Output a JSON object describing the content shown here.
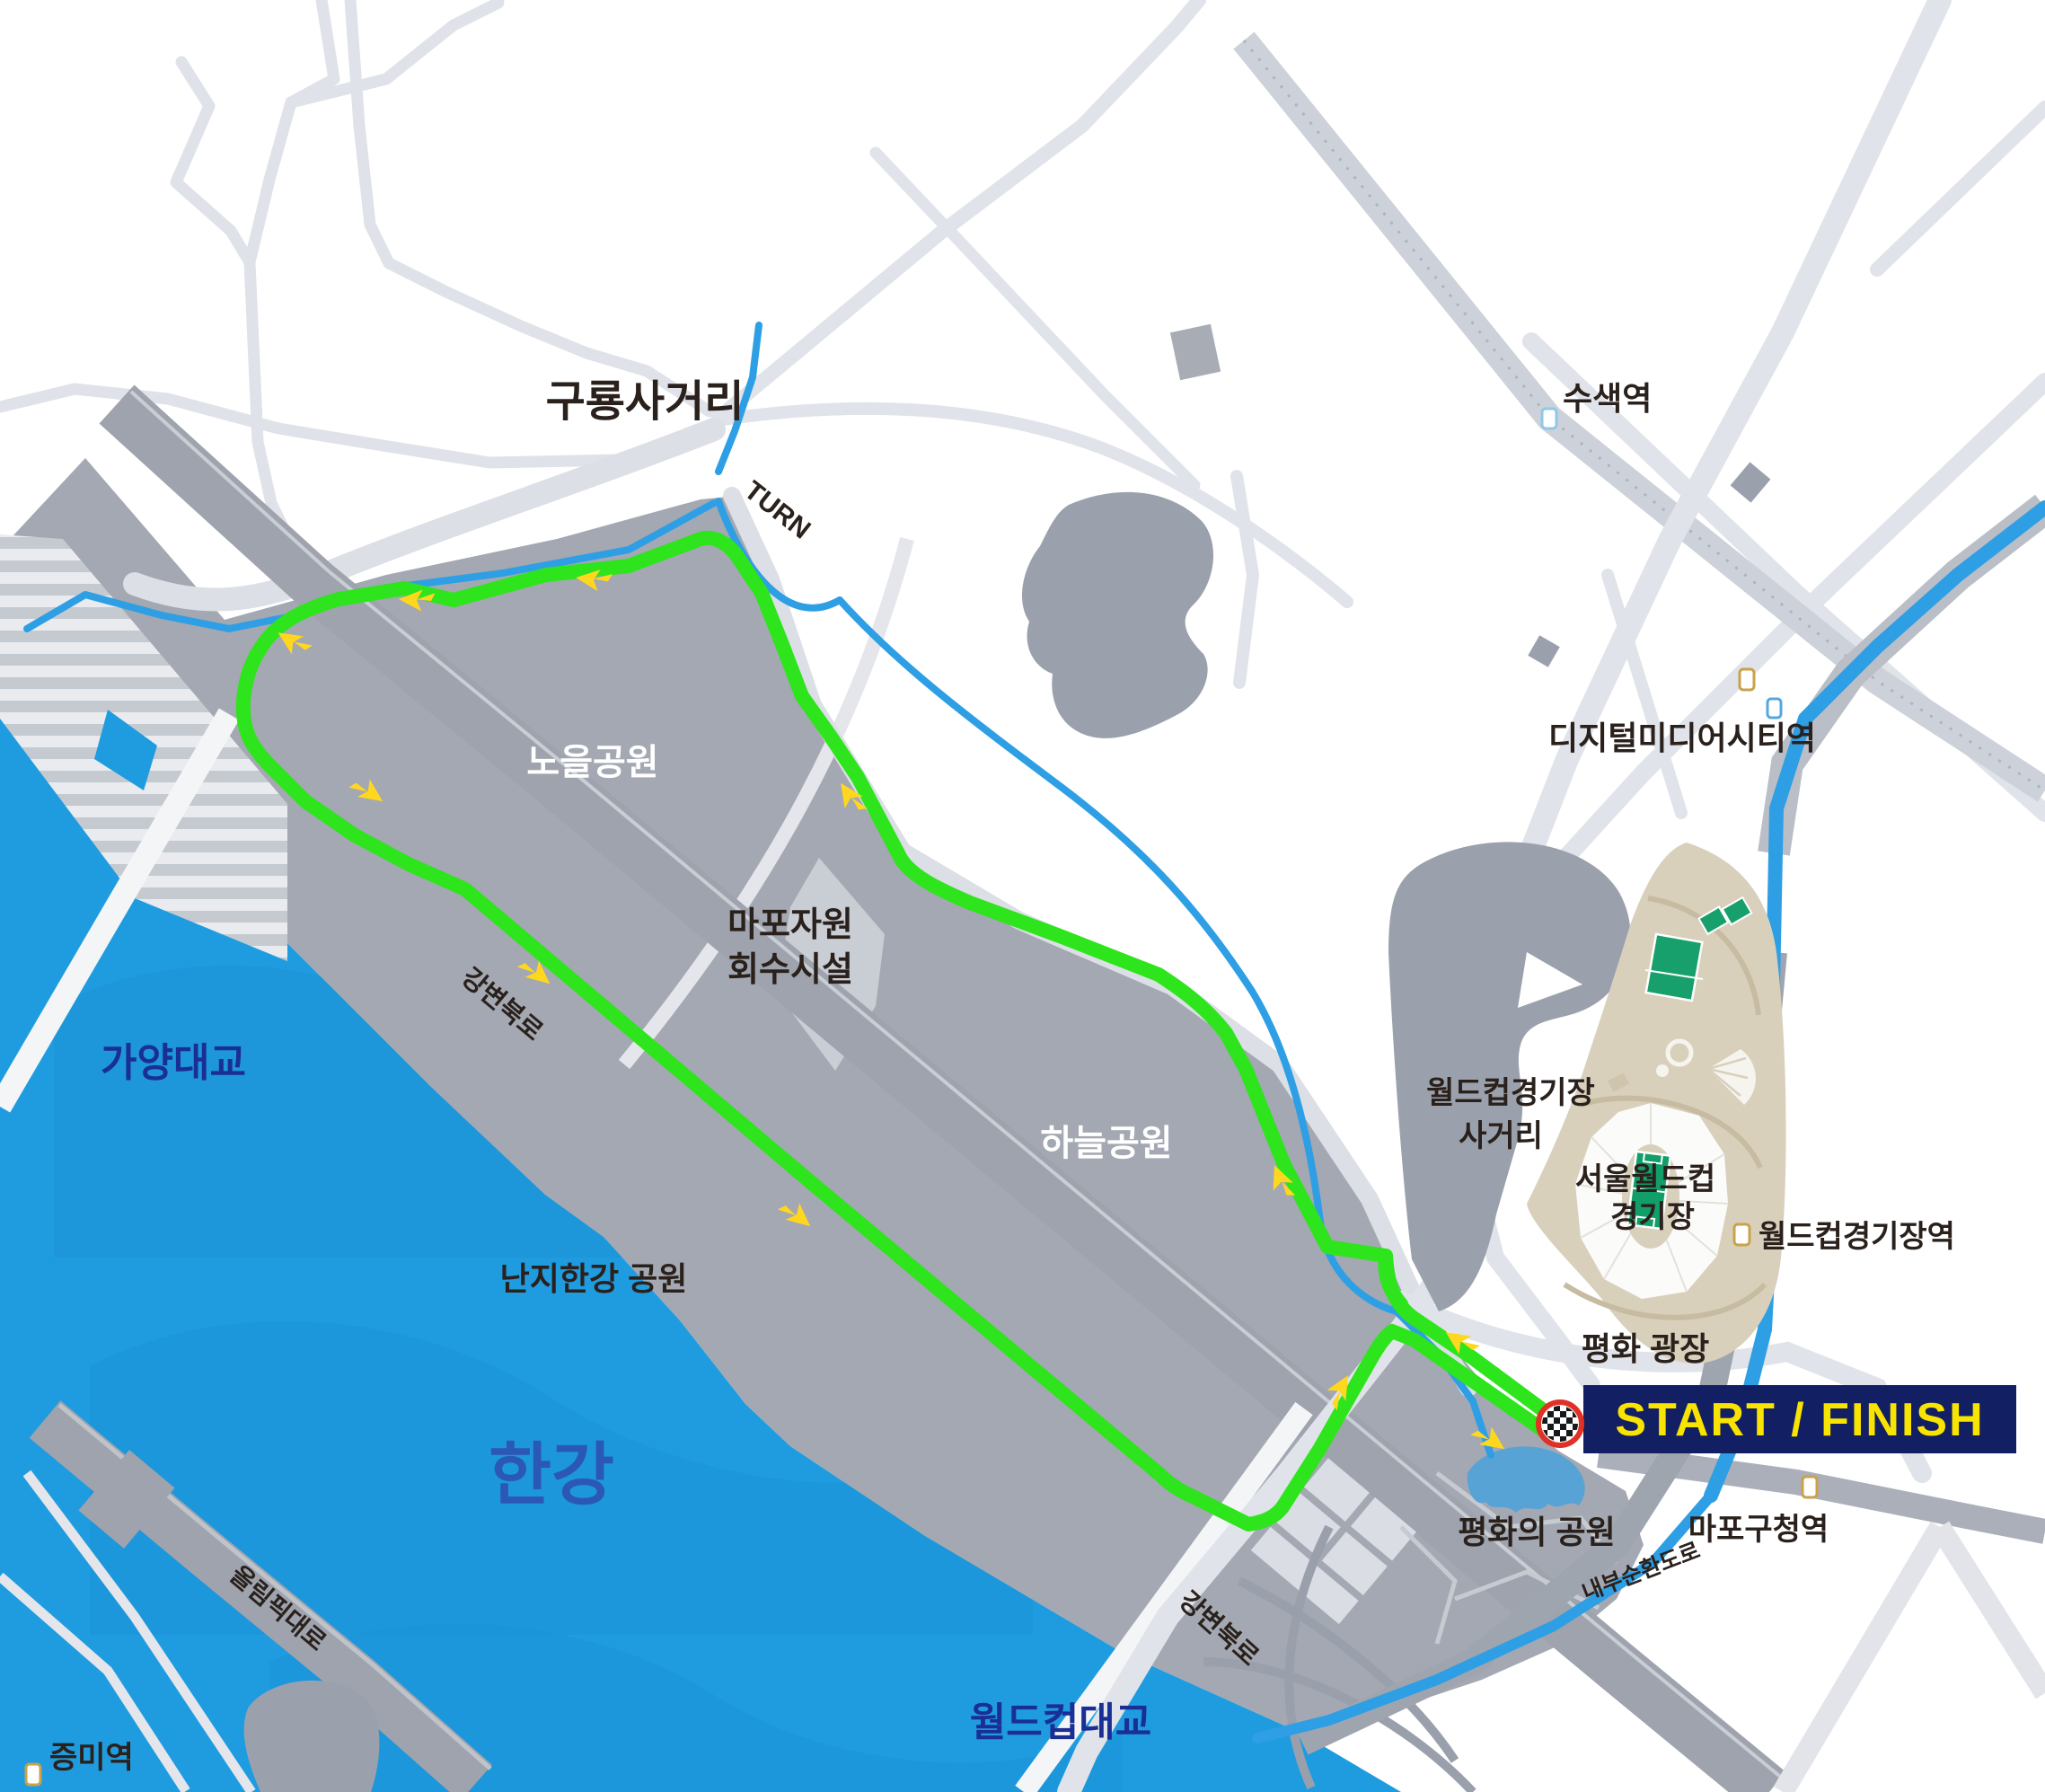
{
  "map_title": "Seoul World Cup Stadium area race course map",
  "labels": {
    "guryong_sageori": "구룡사거리",
    "turn": "TURN",
    "susaek_station": "수색역",
    "dmc_station": "디지털미디어시티역",
    "noeul_park": "노을공원",
    "mapo_facility_line1": "마포자원",
    "mapo_facility_line2": "회수시설",
    "haneul_park": "하늘공원",
    "gangbyeon_expressway": "강변북로",
    "gayang_bridge": "가양대교",
    "nanji_hangang_park": "난지한강 공원",
    "hangang_river": "한강",
    "worldcup_bridge": "월드컵대교",
    "olympic_expressway": "올림픽대로",
    "jeungmi_station": "증미역",
    "wc_stadium_sageori_line1": "월드컵경기장",
    "wc_stadium_sageori_line2": "사거리",
    "seoul_wc_stadium_line1": "서울월드컵",
    "seoul_wc_stadium_line2": "경기장",
    "wc_stadium_station": "월드컵경기장역",
    "pyeonghwa_plaza": "평화 광장",
    "mapo_gu_office_station": "마포구청역",
    "pyeonghwa_park": "평화의 공원",
    "naebu_expressway": "내부순환도로",
    "start_finish": "START / FINISH"
  },
  "colors": {
    "route_green": "#2EE41C",
    "arrow_yellow": "#FFD71E",
    "river_blue": "#1F9CE0",
    "stream_blue": "#2E9FE4",
    "pond_blue": "#58A3D6",
    "park_gray": "#A3A8B2",
    "blob_gray": "#9BA1AC",
    "expressway_gray": "#9EA3AD",
    "road_light_gray": "#E0E3E9",
    "stadium_beige": "#D9D0BC",
    "pitch_green": "#149E6A",
    "start_box_navy": "#121F63",
    "start_text_yellow": "#F8E400",
    "checker_ring_red": "#E03127",
    "bridge_label_navy": "#1A2F96",
    "hangang_label_blue": "#2B57B5",
    "dark_label": "#2A211C",
    "station_icon_tan": "#C9A24B",
    "station_icon_blue": "#55A8DF",
    "station_icon_lightblue": "#8FC8E8"
  }
}
